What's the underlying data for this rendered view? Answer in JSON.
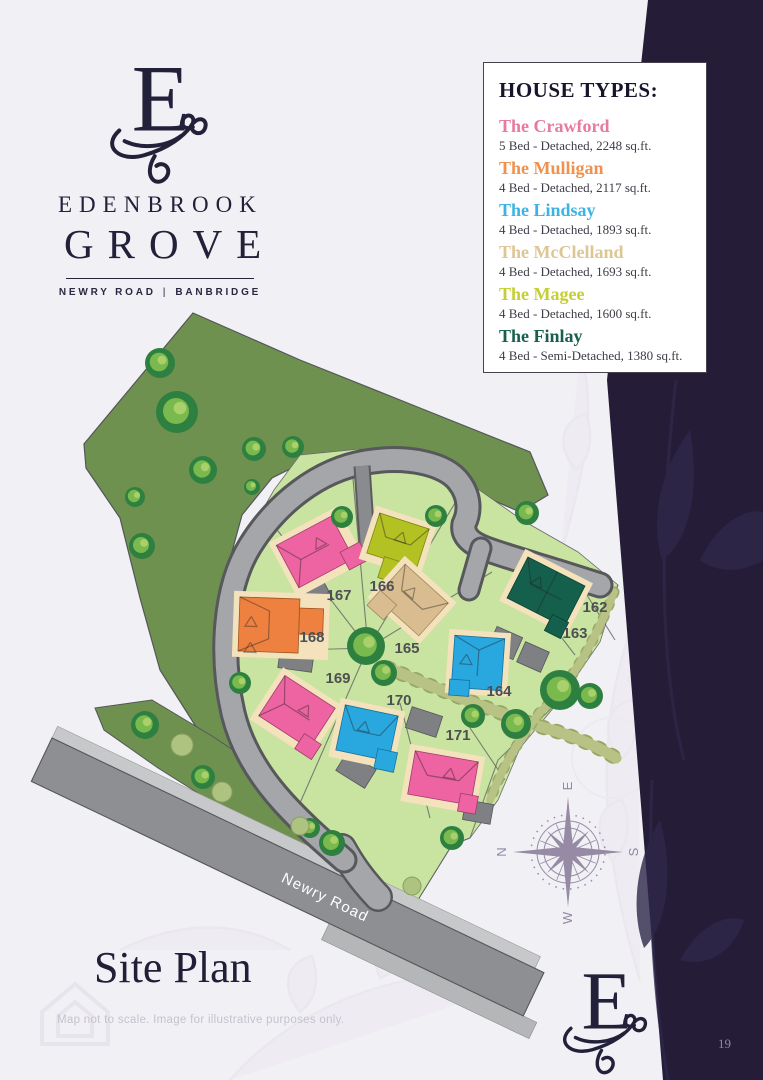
{
  "brand": {
    "monogram": "E",
    "name": "EDENBROOK",
    "name2": "GROVE",
    "location_left": "NEWRY ROAD",
    "location_divider": "|",
    "location_right": "BANBRIDGE"
  },
  "legend": {
    "title": "HOUSE TYPES:",
    "entries": [
      {
        "name": "The Crawford",
        "detail": "5 Bed - Detached, 2248 sq.ft.",
        "color": "#e8799f",
        "house_color": "#ee63a1"
      },
      {
        "name": "The Mulligan",
        "detail": "4 Bed - Detached, 2117 sq.ft.",
        "color": "#f0914e",
        "house_color": "#ee8140"
      },
      {
        "name": "The Lindsay",
        "detail": "4 Bed - Detached, 1893 sq.ft.",
        "color": "#3bb3e6",
        "house_color": "#29a8e0"
      },
      {
        "name": "The McClelland",
        "detail": "4 Bed - Detached, 1693 sq.ft.",
        "color": "#ddc693",
        "house_color": "#d9bd90"
      },
      {
        "name": "The Magee",
        "detail": "4 Bed - Detached, 1600 sq.ft.",
        "color": "#c3cf33",
        "house_color": "#b4c122"
      },
      {
        "name": "The Finlay",
        "detail": "4 Bed - Semi-Detached, 1380 sq.ft.",
        "color": "#17604d",
        "house_color": "#14604c"
      }
    ]
  },
  "site_plan": {
    "title": "Site Plan",
    "disclaimer": "Map not to scale. Image for illustrative purposes only.",
    "road_label": "Newry Road",
    "compass": {
      "n": "N",
      "e": "E",
      "s": "S",
      "w": "W"
    },
    "plots": [
      {
        "number": "162",
        "house_type": "The Finlay"
      },
      {
        "number": "163",
        "house_type": "The Finlay"
      },
      {
        "number": "164",
        "house_type": "The Lindsay"
      },
      {
        "number": "165",
        "house_type": "The McClelland"
      },
      {
        "number": "166",
        "house_type": "The Magee"
      },
      {
        "number": "167",
        "house_type": "The Crawford"
      },
      {
        "number": "168",
        "house_type": "The Mulligan"
      },
      {
        "number": "169",
        "house_type": "The Crawford"
      },
      {
        "number": "170",
        "house_type": "The Lindsay"
      },
      {
        "number": "171",
        "house_type": "The Crawford"
      }
    ]
  },
  "footer": {
    "page_number": "19"
  },
  "colors": {
    "dark_band": "#251d38",
    "field_green": "#6f9150",
    "parcel_green": "#c9e3a0",
    "accent_dark": "#23203a",
    "page_bg": "#f1f0f4"
  }
}
